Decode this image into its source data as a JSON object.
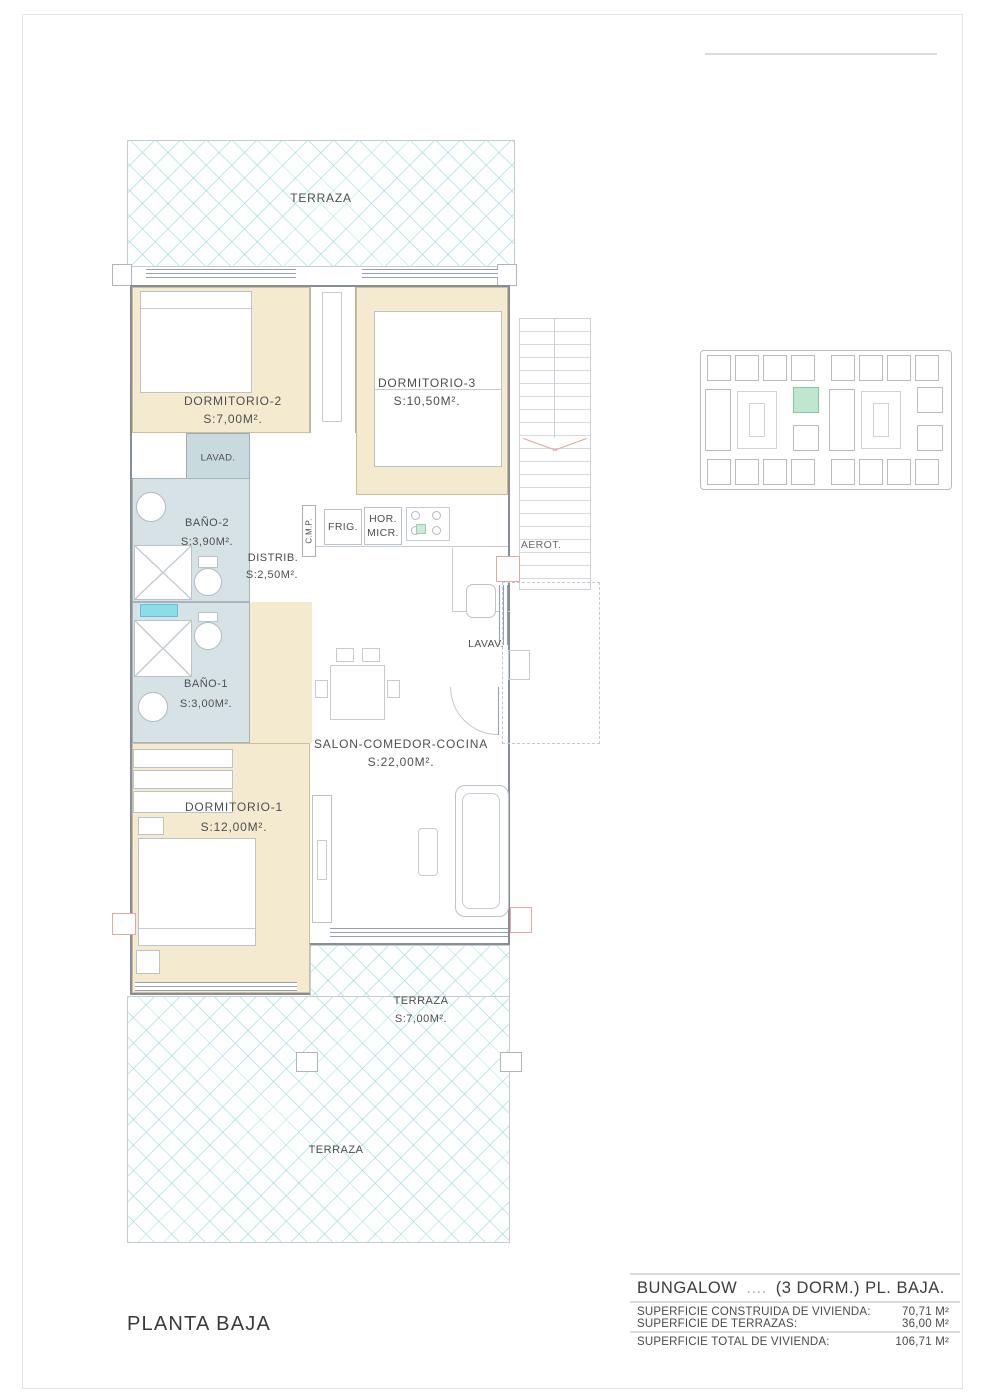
{
  "sheet": {
    "plan_title": "PLANTA BAJA"
  },
  "rooms": {
    "terraza_top": {
      "label": "TERRAZA"
    },
    "dormitorio2": {
      "label": "DORMITORIO-2",
      "area": "S:7,00M²."
    },
    "dormitorio3": {
      "label": "DORMITORIO-3",
      "area": "S:10,50M²."
    },
    "lavadero": {
      "label": "LAVAD."
    },
    "bano2": {
      "label": "BAÑO-2",
      "area": "S:3,90M²."
    },
    "distribuidor": {
      "label": "DISTRIB.",
      "area": "S:2,50M²."
    },
    "bano1": {
      "label": "BAÑO-1",
      "area": "S:3,00M²."
    },
    "salon": {
      "label": "SALON-COMEDOR-COCINA",
      "area": "S:22,00M²."
    },
    "dormitorio1": {
      "label": "DORMITORIO-1",
      "area": "S:12,00M²."
    },
    "terraza_media": {
      "label": "TERRAZA",
      "area": "S:7,00M²."
    },
    "terraza_inferior": {
      "label": "TERRAZA"
    }
  },
  "annotations": {
    "cmp": "C.M.P.",
    "frigorifico": "FRIG.",
    "horno": "HOR.",
    "microondas": "MICR.",
    "aerotermia": "AEROT.",
    "lavavajillas": "LAVAV."
  },
  "title_block": {
    "unit_type": "BUNGALOW",
    "unit_number": "....",
    "unit_suffix": "(3 DORM.)  PL. BAJA.",
    "rows": [
      {
        "label": "SUPERFICIE CONSTRUIDA DE VIVIENDA:",
        "value": "70,71 M²"
      },
      {
        "label": "SUPERFICIE DE TERRAZAS:",
        "value": "36,00 M²"
      },
      {
        "label": "SUPERFICIE TOTAL DE VIVIENDA:",
        "value": "106,71 M²"
      }
    ]
  },
  "colors": {
    "bedroom_fill": "#f4ead0",
    "bath_fill": "#d6e2e6",
    "hatch_line": "#7dcdd2",
    "highlight_unit": "#bfe7cf"
  }
}
